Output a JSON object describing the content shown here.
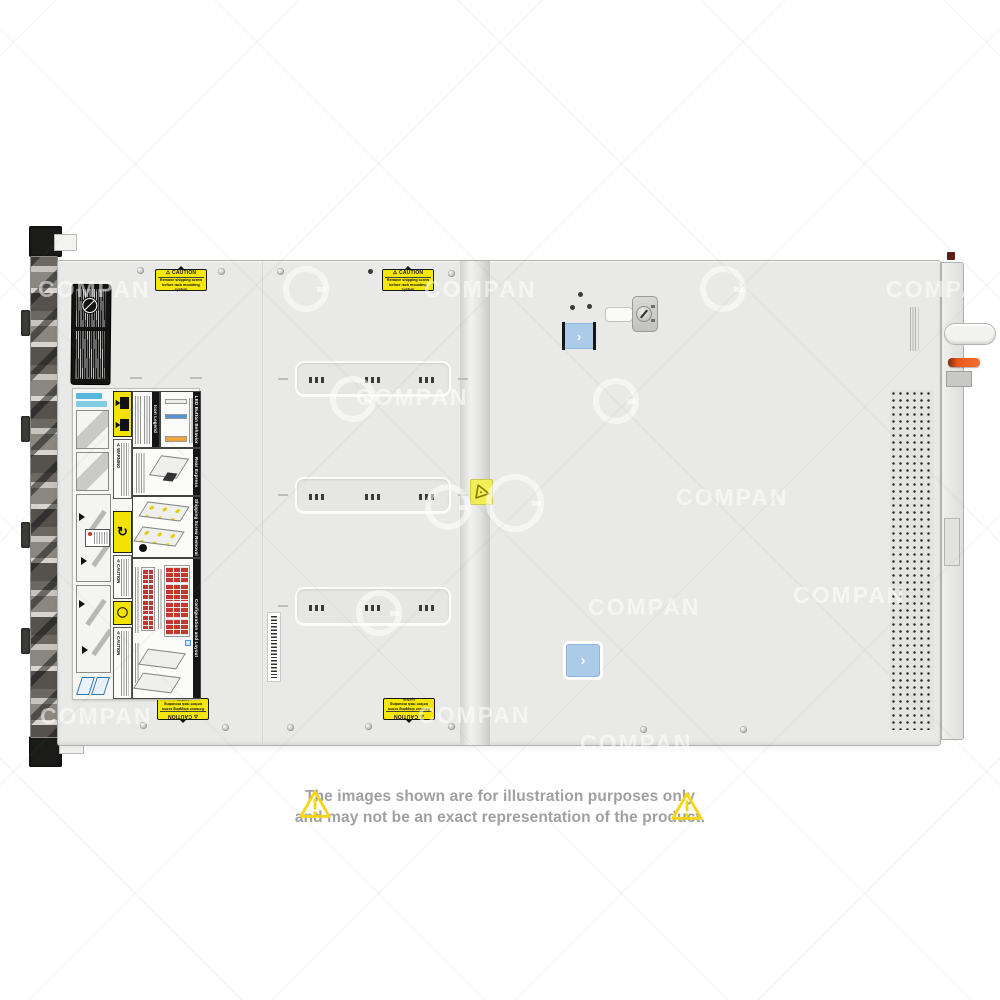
{
  "watermark": {
    "text": "COMPAN"
  },
  "disclaimer": {
    "line1": "The images shown are for illustration purposes only",
    "line2": "and may not be an exact representation of the product."
  },
  "stickers": {
    "caution": {
      "symbol": "⚠",
      "header": "CAUTION",
      "line1": "Remove shipping screw",
      "line2": "before rack mounting system"
    }
  },
  "service_label": {
    "sections": {
      "icon_legend": "Icon Legend",
      "led": "LED Button Behavior",
      "tag": "Rear Express Service Tag",
      "screw": "Shipping Screw Removal",
      "config": "Configuration and Layout"
    },
    "strips": {
      "warning": "⚠ WARNING",
      "caution": "⚠ CAUTION"
    }
  },
  "controls": {
    "latch_chevron": "›"
  },
  "colors": {
    "sticker_yellow": "#F6E70B",
    "latch_blue": "#ABCBE9",
    "lever_orange": "#E8581A",
    "led_blue": "#4F93D8",
    "led_amber": "#F0A43A",
    "drive_red": "#C5372D",
    "triangle_yellow": "#F7D516",
    "disclaimer_gray": "#A0A0A0"
  }
}
